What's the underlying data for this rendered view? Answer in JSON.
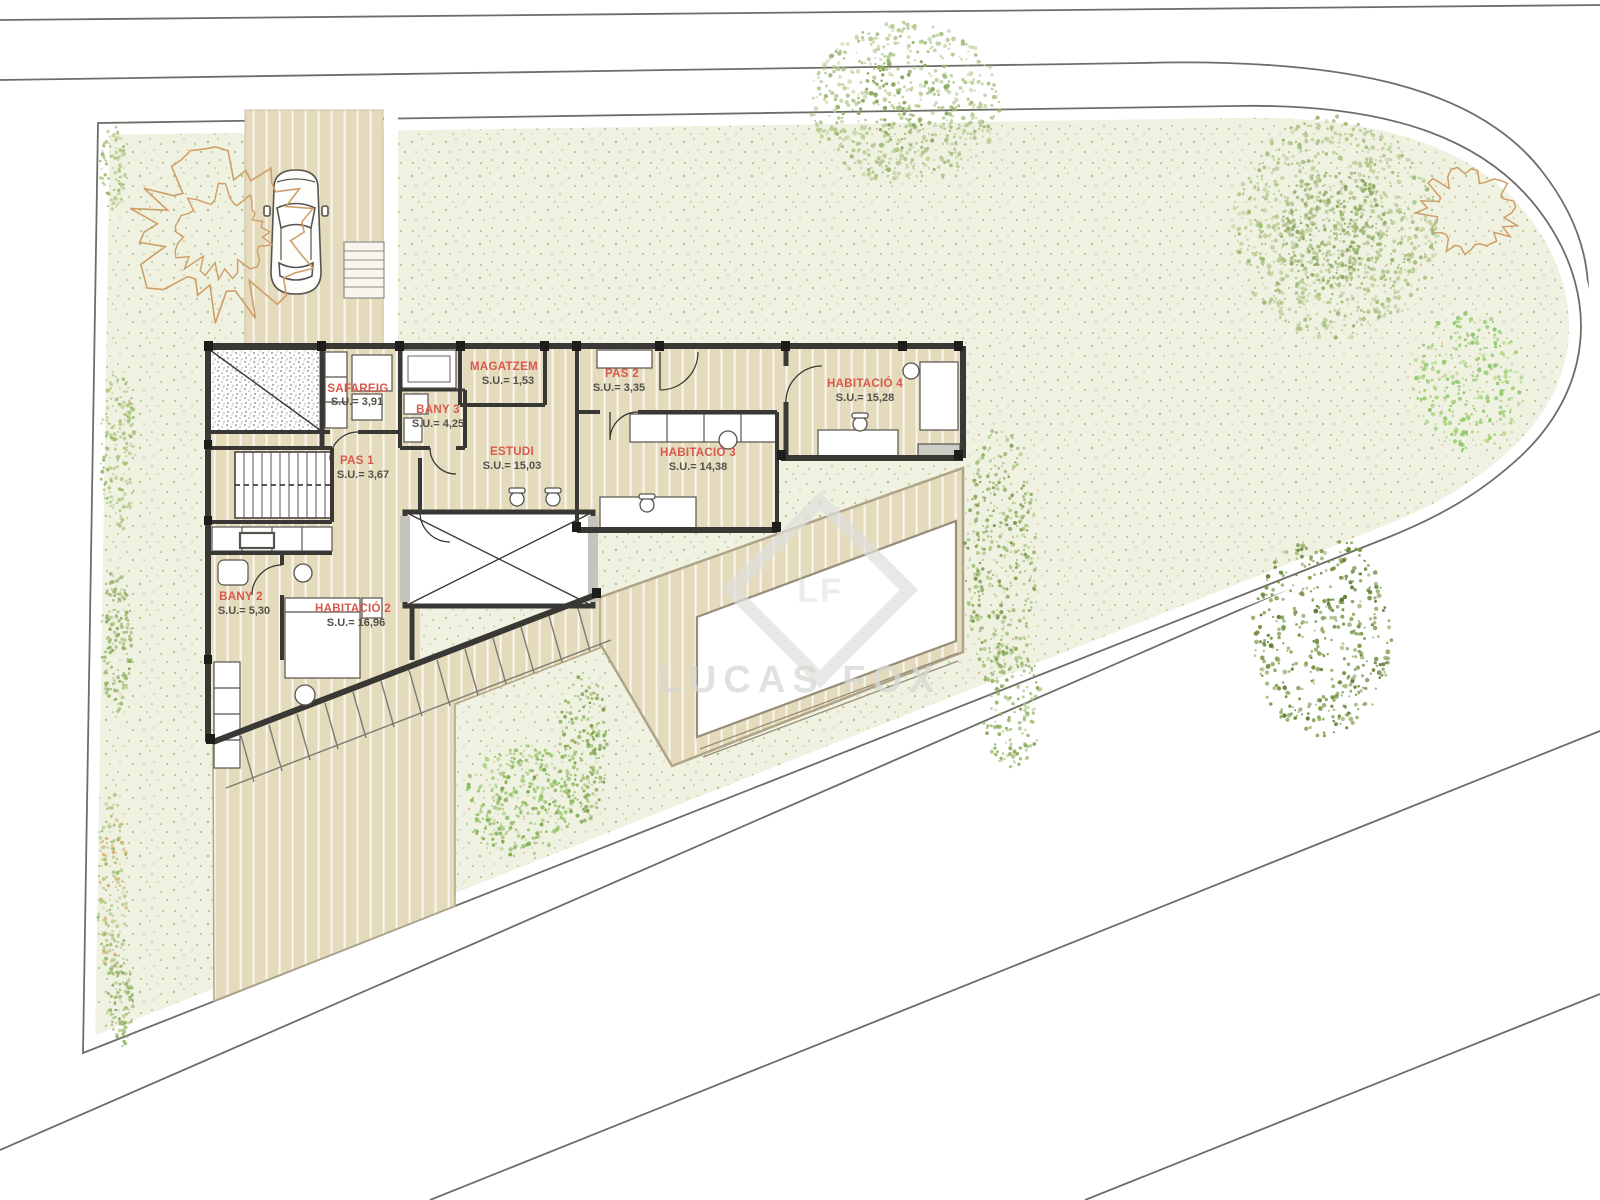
{
  "document": {
    "kind": "architectural site & floor plan",
    "watermark": {
      "brand": "LUCAS FOX",
      "monogram": "LF"
    }
  },
  "rooms": [
    {
      "name": "SAFAREIG",
      "area": "S.U.= 3,91"
    },
    {
      "name": "BANY 3",
      "area": "S.U.= 4,25"
    },
    {
      "name": "MAGATZEM",
      "area": "S.U.= 1,53"
    },
    {
      "name": "PAS 1",
      "area": "S.U.= 3,67"
    },
    {
      "name": "PAS 2",
      "area": "S.U.= 3,35"
    },
    {
      "name": "ESTUDI",
      "area": "S.U.= 15,03"
    },
    {
      "name": "HABITACIÓ 3",
      "area": "S.U.= 14,38"
    },
    {
      "name": "HABITACIÓ 4",
      "area": "S.U.= 15,28"
    },
    {
      "name": "BANY 2",
      "area": "S.U.= 5,30"
    },
    {
      "name": "HABITACIÓ 2",
      "area": "S.U.= 16,96"
    }
  ],
  "colors": {
    "label_red": "#d9584c",
    "value_gray": "#53514a",
    "wall": "#3a3834",
    "deck": "#e4dabc",
    "garden": "#eff1e1",
    "road_line": "#6e6e68"
  }
}
